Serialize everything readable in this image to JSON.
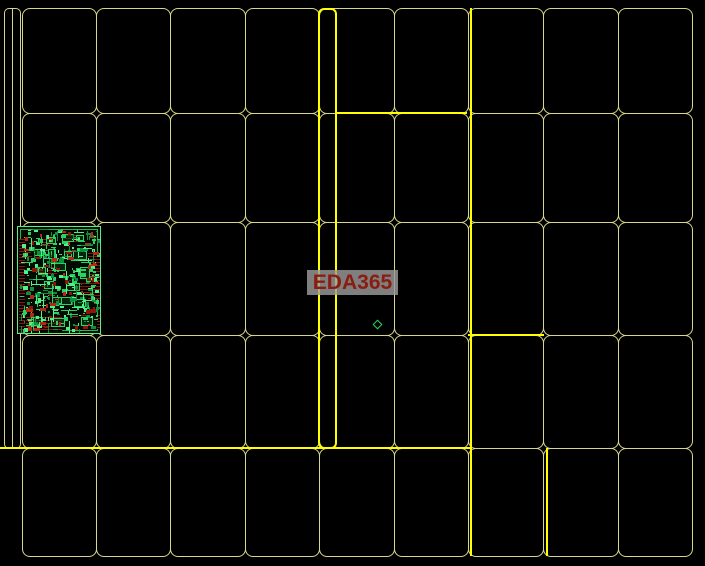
{
  "app": {
    "type": "pcb-cam-panel-view",
    "background_color": "#000000"
  },
  "watermark": {
    "text": "EDA365",
    "text_color": "#8b1c10",
    "background_color": "#9b9b9b"
  },
  "panel": {
    "columns": 9,
    "rows": 5,
    "outline_color": "#d6d68c",
    "highlight_color": "#ffff00"
  },
  "pcb": {
    "trace_color": "#2ad163",
    "trace_bright_color": "#54f087",
    "trace_dark_color": "#0e8f3d",
    "pad_color": "#8f1505",
    "pad_bright_color": "#b5270f"
  },
  "marker": {
    "shape": "diamond",
    "color": "#2ad163"
  }
}
